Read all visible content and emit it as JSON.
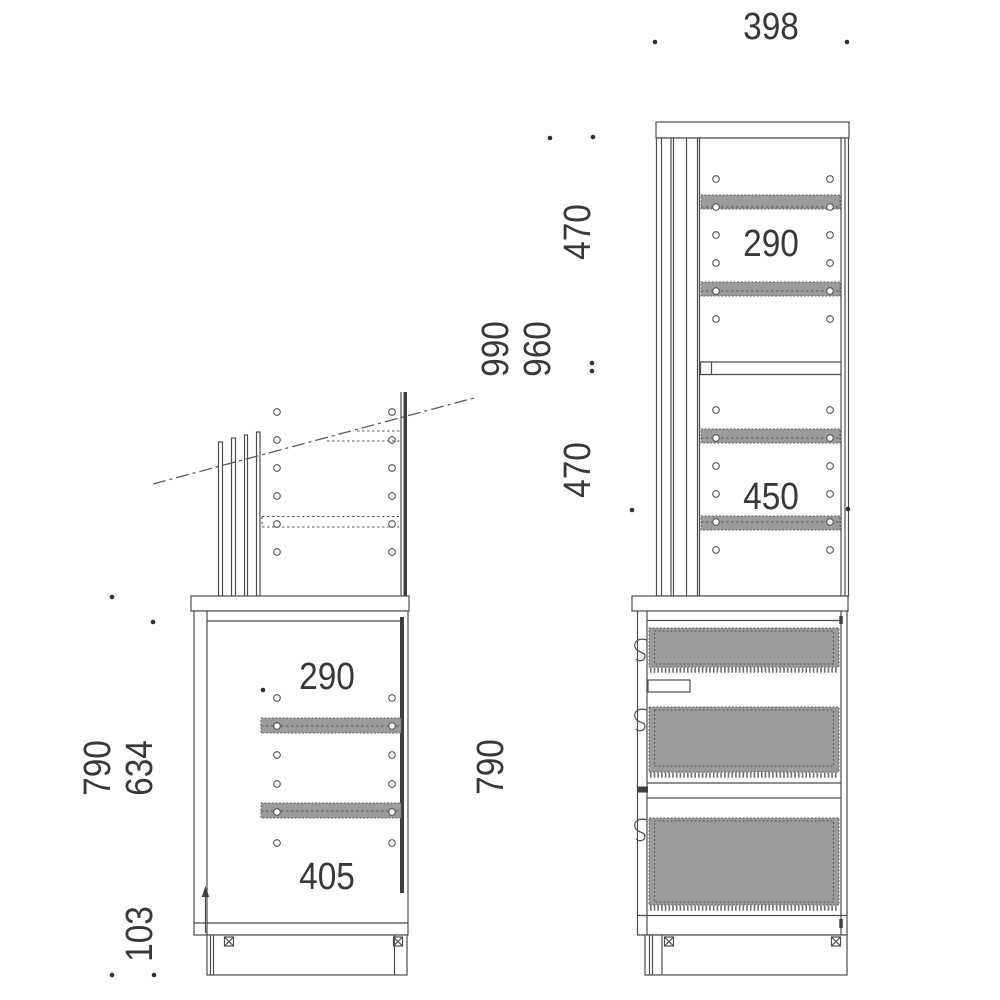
{
  "drawing": {
    "background": "#ffffff",
    "line_color": "#4d4d4d",
    "panel_fill": "#9a9c9e",
    "text_color": "#383838",
    "front_view": {
      "width_top": "398",
      "upper_gap_top": "470",
      "upper_gap_bottom": "470",
      "shelf_space_top": "290",
      "shelf_space_bottom": "450",
      "lower_cabinet_height": "790"
    },
    "side_view": {
      "overall_height_max": "990",
      "overall_height_min": "960",
      "lower_cabinet_height": "790",
      "lower_inner_height": "634",
      "base_height": "103",
      "shelf_space_top": "290",
      "shelf_space_bottom": "405"
    }
  }
}
